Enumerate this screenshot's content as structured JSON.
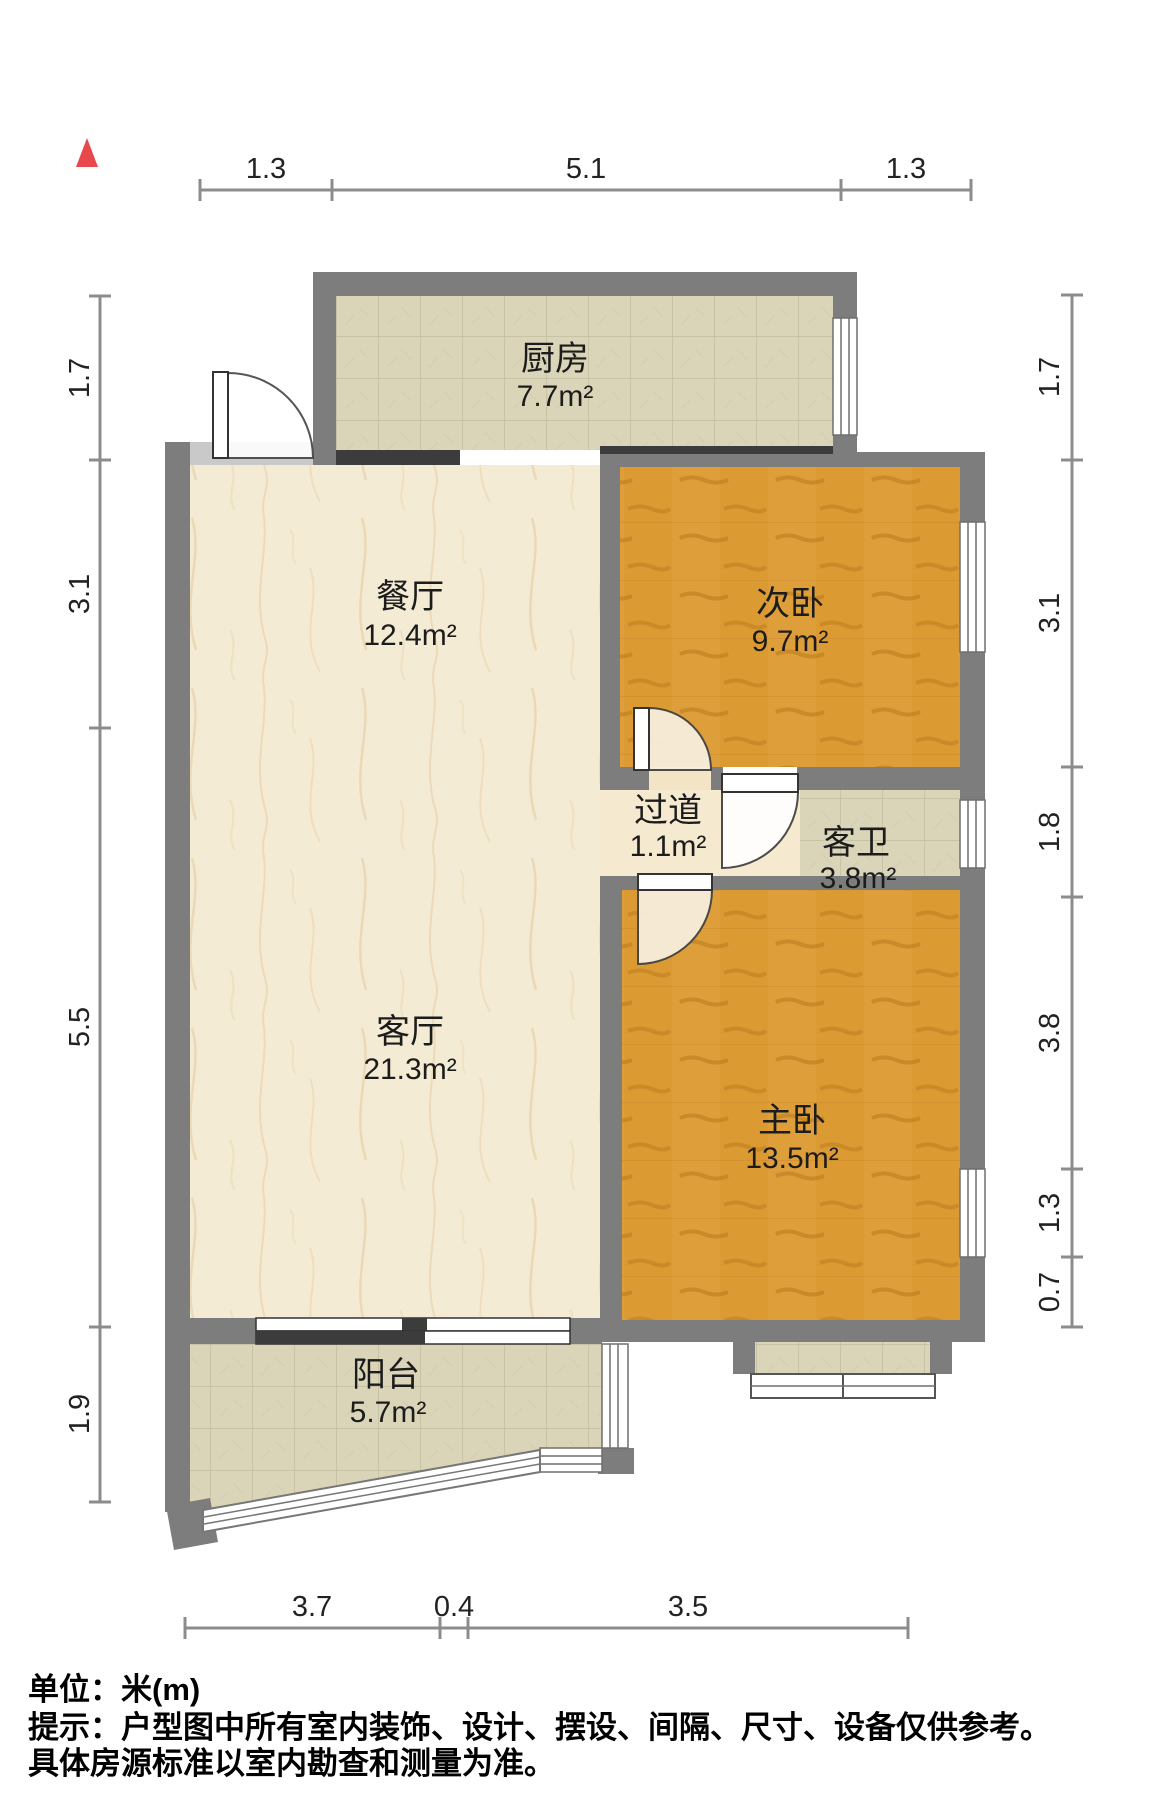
{
  "compass": {
    "marker": "north-triangle",
    "color": "#e8474b"
  },
  "rooms": [
    {
      "id": "kitchen",
      "name": "厨房",
      "area": "7.7m²"
    },
    {
      "id": "dining-room",
      "name": "餐厅",
      "area": "12.4m²"
    },
    {
      "id": "second-bedroom",
      "name": "次卧",
      "area": "9.7m²"
    },
    {
      "id": "hallway",
      "name": "过道",
      "area": "1.1m²"
    },
    {
      "id": "guest-bathroom",
      "name": "客卫",
      "area": "3.8m²"
    },
    {
      "id": "living-room",
      "name": "客厅",
      "area": "21.3m²"
    },
    {
      "id": "master-bedroom",
      "name": "主卧",
      "area": "13.5m²"
    },
    {
      "id": "balcony",
      "name": "阳台",
      "area": "5.7m²"
    }
  ],
  "dimensions": {
    "top": [
      "1.3",
      "5.1",
      "1.3"
    ],
    "left": [
      "1.7",
      "3.1",
      "5.5",
      "1.9"
    ],
    "right": [
      "1.7",
      "3.1",
      "1.8",
      "3.8",
      "1.3",
      "0.7"
    ],
    "bottom": [
      "3.7",
      "0.4",
      "3.5"
    ]
  },
  "footer": {
    "unit": "单位：米(m)",
    "hint": "提示：户型图中所有室内装饰、设计、摆设、间隔、尺寸、设备仅供参考。",
    "hint2": "具体房源标准以室内勘查和测量为准。"
  },
  "colors": {
    "wall": "#7d7d7d",
    "dark_rail": "#3c3c3c",
    "wood": "#dc9a33",
    "tile": "#dad5b8",
    "marble": "#f4ebd4",
    "threshold": "#c9c9c9",
    "accent_red": "#e8474b"
  }
}
